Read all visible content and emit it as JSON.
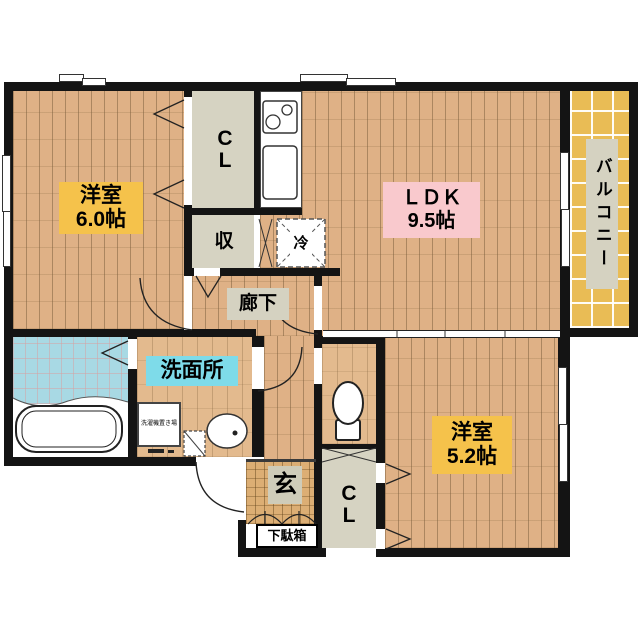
{
  "plan_title": "floor-plan",
  "rooms": {
    "bedroom1": {
      "name": "洋室",
      "size": "6.0帖"
    },
    "ldk": {
      "name": "ＬＤＫ",
      "size": "9.5帖"
    },
    "bedroom2": {
      "name": "洋室",
      "size": "5.2帖"
    },
    "washroom": {
      "name": "洗面所"
    },
    "hallway": {
      "name": "廊下"
    },
    "balcony": {
      "name": "バルコニー"
    },
    "entrance": {
      "name": "玄"
    },
    "shoe_cabinet": {
      "name": "下駄箱"
    },
    "closet_upper": {
      "name": "CL"
    },
    "closet_lower": {
      "name": "CL"
    },
    "storage": {
      "name": "収"
    },
    "refrigerator": {
      "name": "冷"
    },
    "washer_space": {
      "name": "洗濯機置き場"
    }
  },
  "colors": {
    "wall": "#141414",
    "label_yellow": "#f5c24b",
    "label_pink": "#f9c9cd",
    "label_cyan": "#7edbe9",
    "label_gray": "#d5d2c1",
    "floor_wood": "#dfb186",
    "balcony_tile": "#e9bc55",
    "bath_blue": "#a8d9e4"
  }
}
